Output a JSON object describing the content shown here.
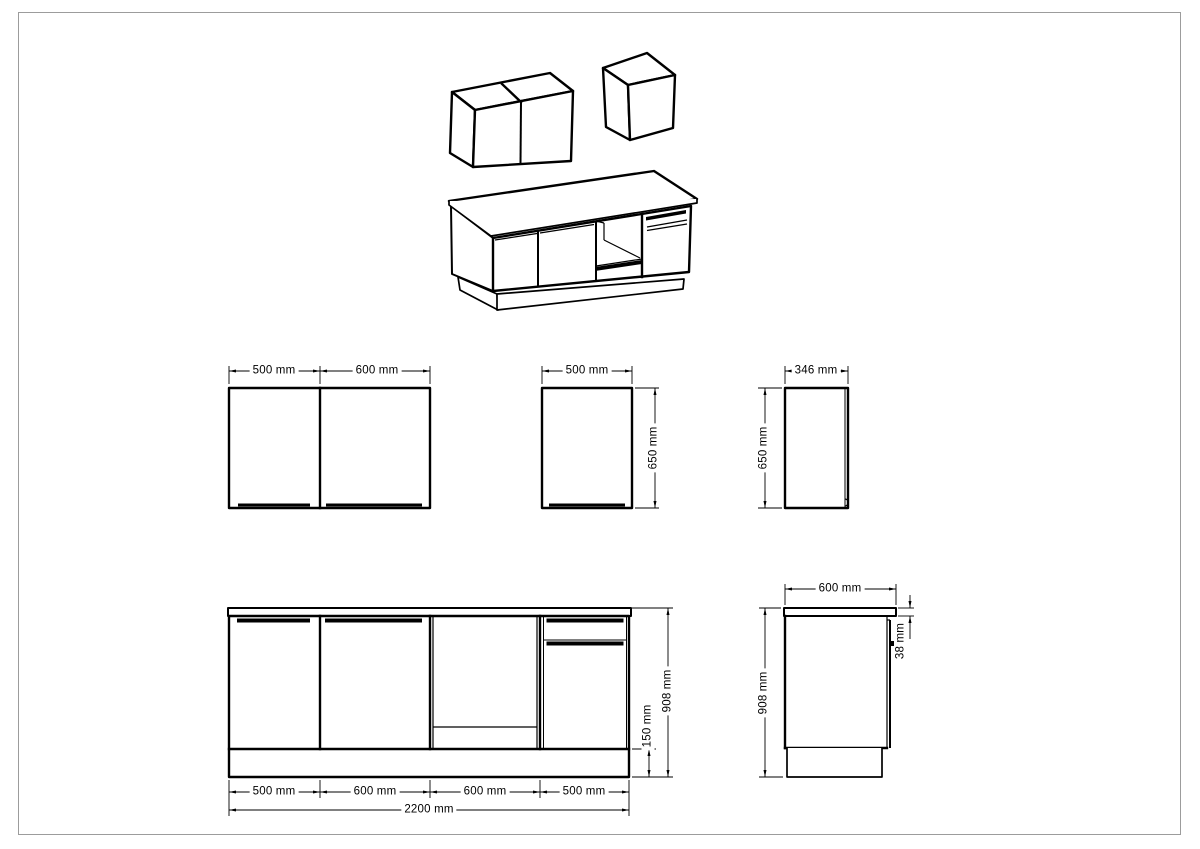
{
  "sheet": {
    "kind": "kitchen cabinet technical drawing",
    "unit": "mm"
  },
  "views": {
    "wall_cabinet_double_front": {
      "dim_width_left": "500 mm",
      "dim_width_right": "600 mm"
    },
    "wall_cabinet_single_front": {
      "dim_width": "500 mm",
      "dim_height": "650 mm"
    },
    "wall_cabinet_side": {
      "dim_depth": "346 mm",
      "dim_height": "650 mm"
    },
    "base_run_front": {
      "dim_segments": [
        "500 mm",
        "600 mm",
        "600 mm",
        "500 mm"
      ],
      "dim_total_width": "2200 mm",
      "dim_plinth_height": "150 mm",
      "dim_height": "908 mm"
    },
    "base_cabinet_side": {
      "dim_depth": "600 mm",
      "dim_height": "908 mm",
      "dim_worktop_thickness": "38 mm"
    }
  },
  "colors": {
    "line": "#000000",
    "sheet_border": "#9c9c9c",
    "background": "#ffffff"
  }
}
